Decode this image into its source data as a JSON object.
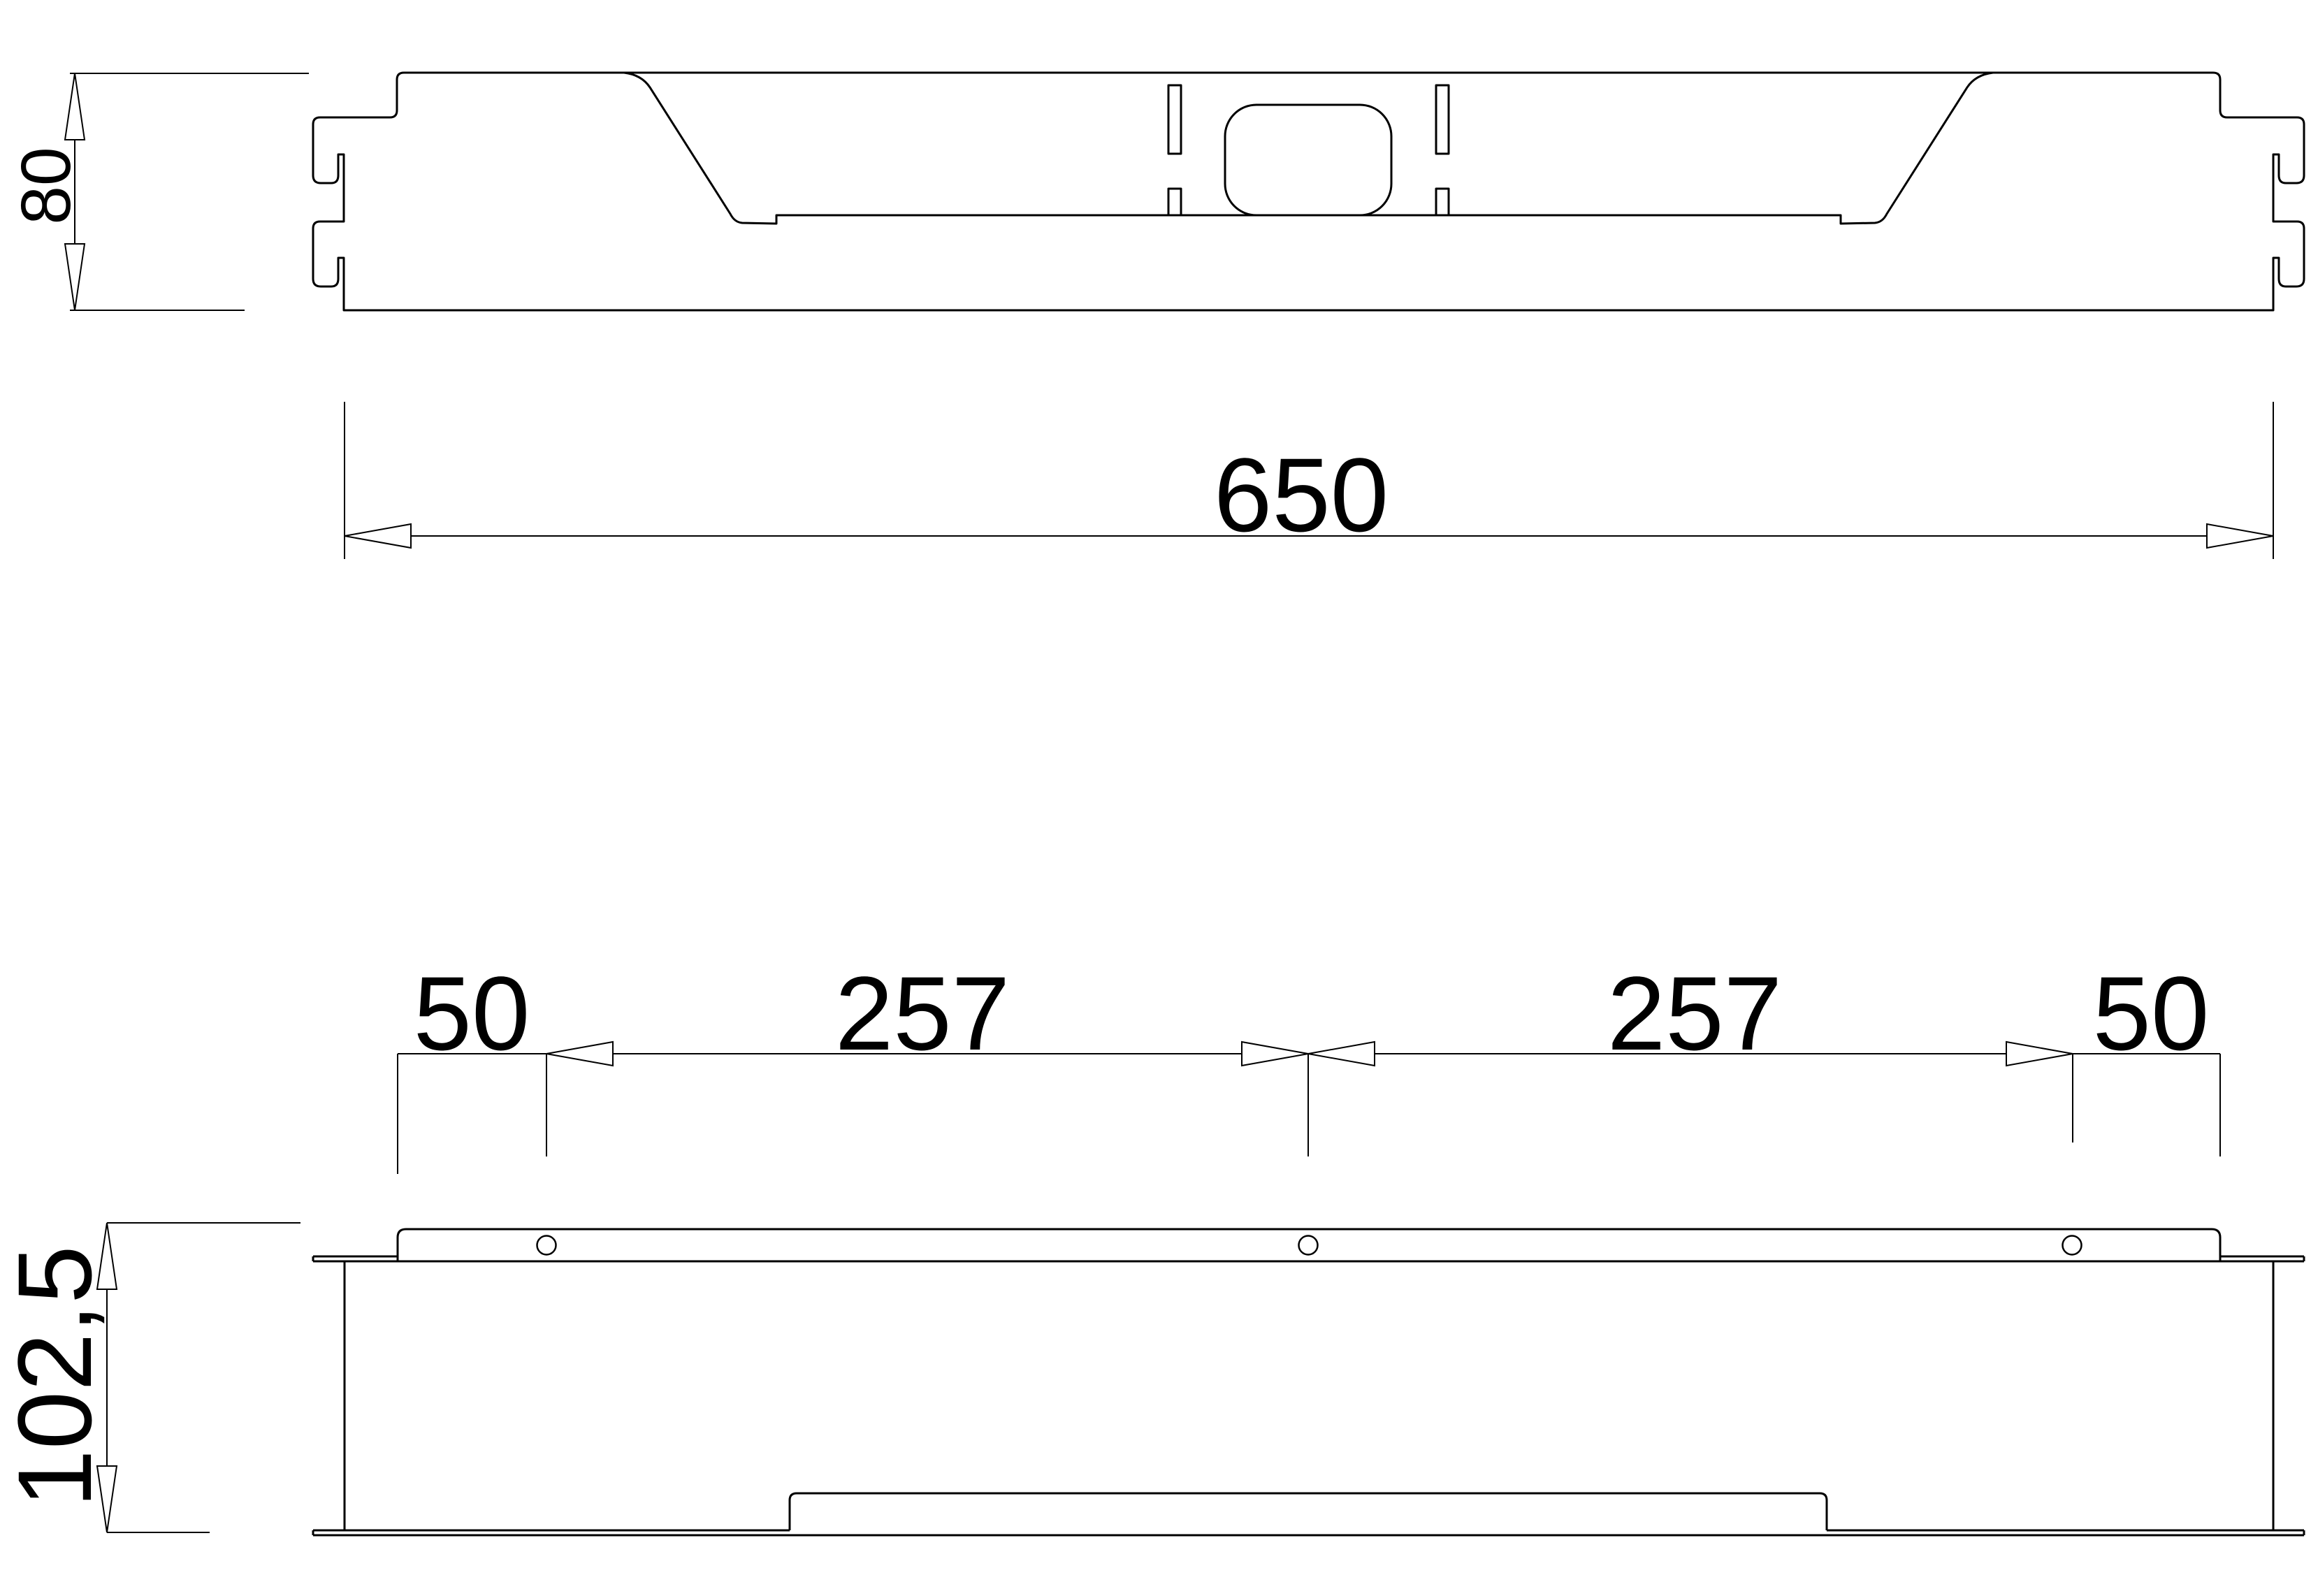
{
  "drawing": {
    "type": "technical-dimension-drawing",
    "views": {
      "front": {
        "dim_height": "80",
        "dim_length": "650"
      },
      "side": {
        "dim_left_margin": "50",
        "dim_pitch_left": "257",
        "dim_pitch_right": "257",
        "dim_right_margin": "50",
        "dim_height": "102,5"
      }
    },
    "colors": {
      "line": "#000000",
      "background": "#ffffff"
    }
  }
}
